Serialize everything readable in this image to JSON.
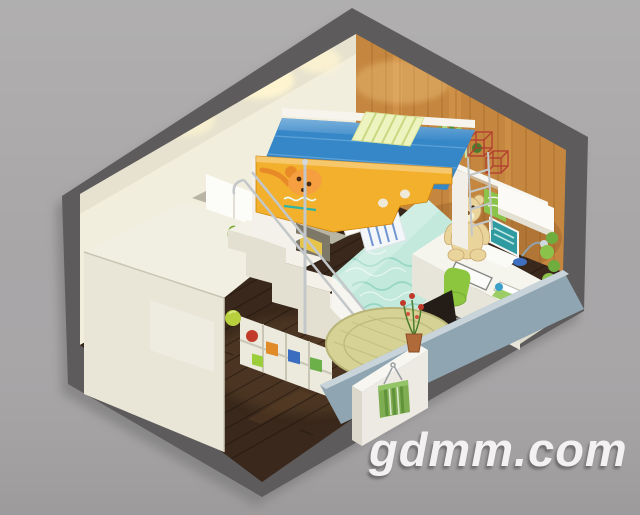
{
  "meta": {
    "scene": "isometric cutaway 3D render of a children's bedroom (dollhouse view)",
    "style": "axonometric room section on gray background",
    "objects": [
      "loft bed with yellow safety guard and dog cartoon",
      "lower bed with teal bedding and pillows",
      "staircase with storage cubbies and toy boxes",
      "chrome handrail and ladder",
      "wardrobe",
      "sliding-door closet recess",
      "wood accent wall with floating shelves",
      "red wire cube decor",
      "desk with laptop, lamp, books and plant",
      "teddy bear",
      "green desk chair",
      "dark display panel",
      "low sideboard with potted red flowers",
      "green laundry basket",
      "round woven rug",
      "dark wood plank floor"
    ]
  },
  "watermark": {
    "text": "gdmm.com",
    "color": "#f3f1f2",
    "shadow_color": "#5f5d5e"
  },
  "palette": {
    "background": "#a8a6a7",
    "shell": "#5d5b5c",
    "wall_back": "#f2eedd",
    "wall_wood": "#c5873f",
    "wall_front": "#8fa5b1",
    "wall_front_top": "#c8d4da",
    "floor": "#39281b",
    "wardrobe": "#e9e6d7",
    "wardrobe_top": "#f1efe2",
    "mattress_blue": "#3687c8",
    "guard_yellow": "#f2b02c",
    "bedding_teal": "#c2e9db",
    "rug": "#d6d295",
    "chair_green": "#8cc63f",
    "basket_green": "#7fae52",
    "bear_tan": "#e9d49c",
    "chrome": "#c3c7ca",
    "red_decor": "#b2392e"
  }
}
